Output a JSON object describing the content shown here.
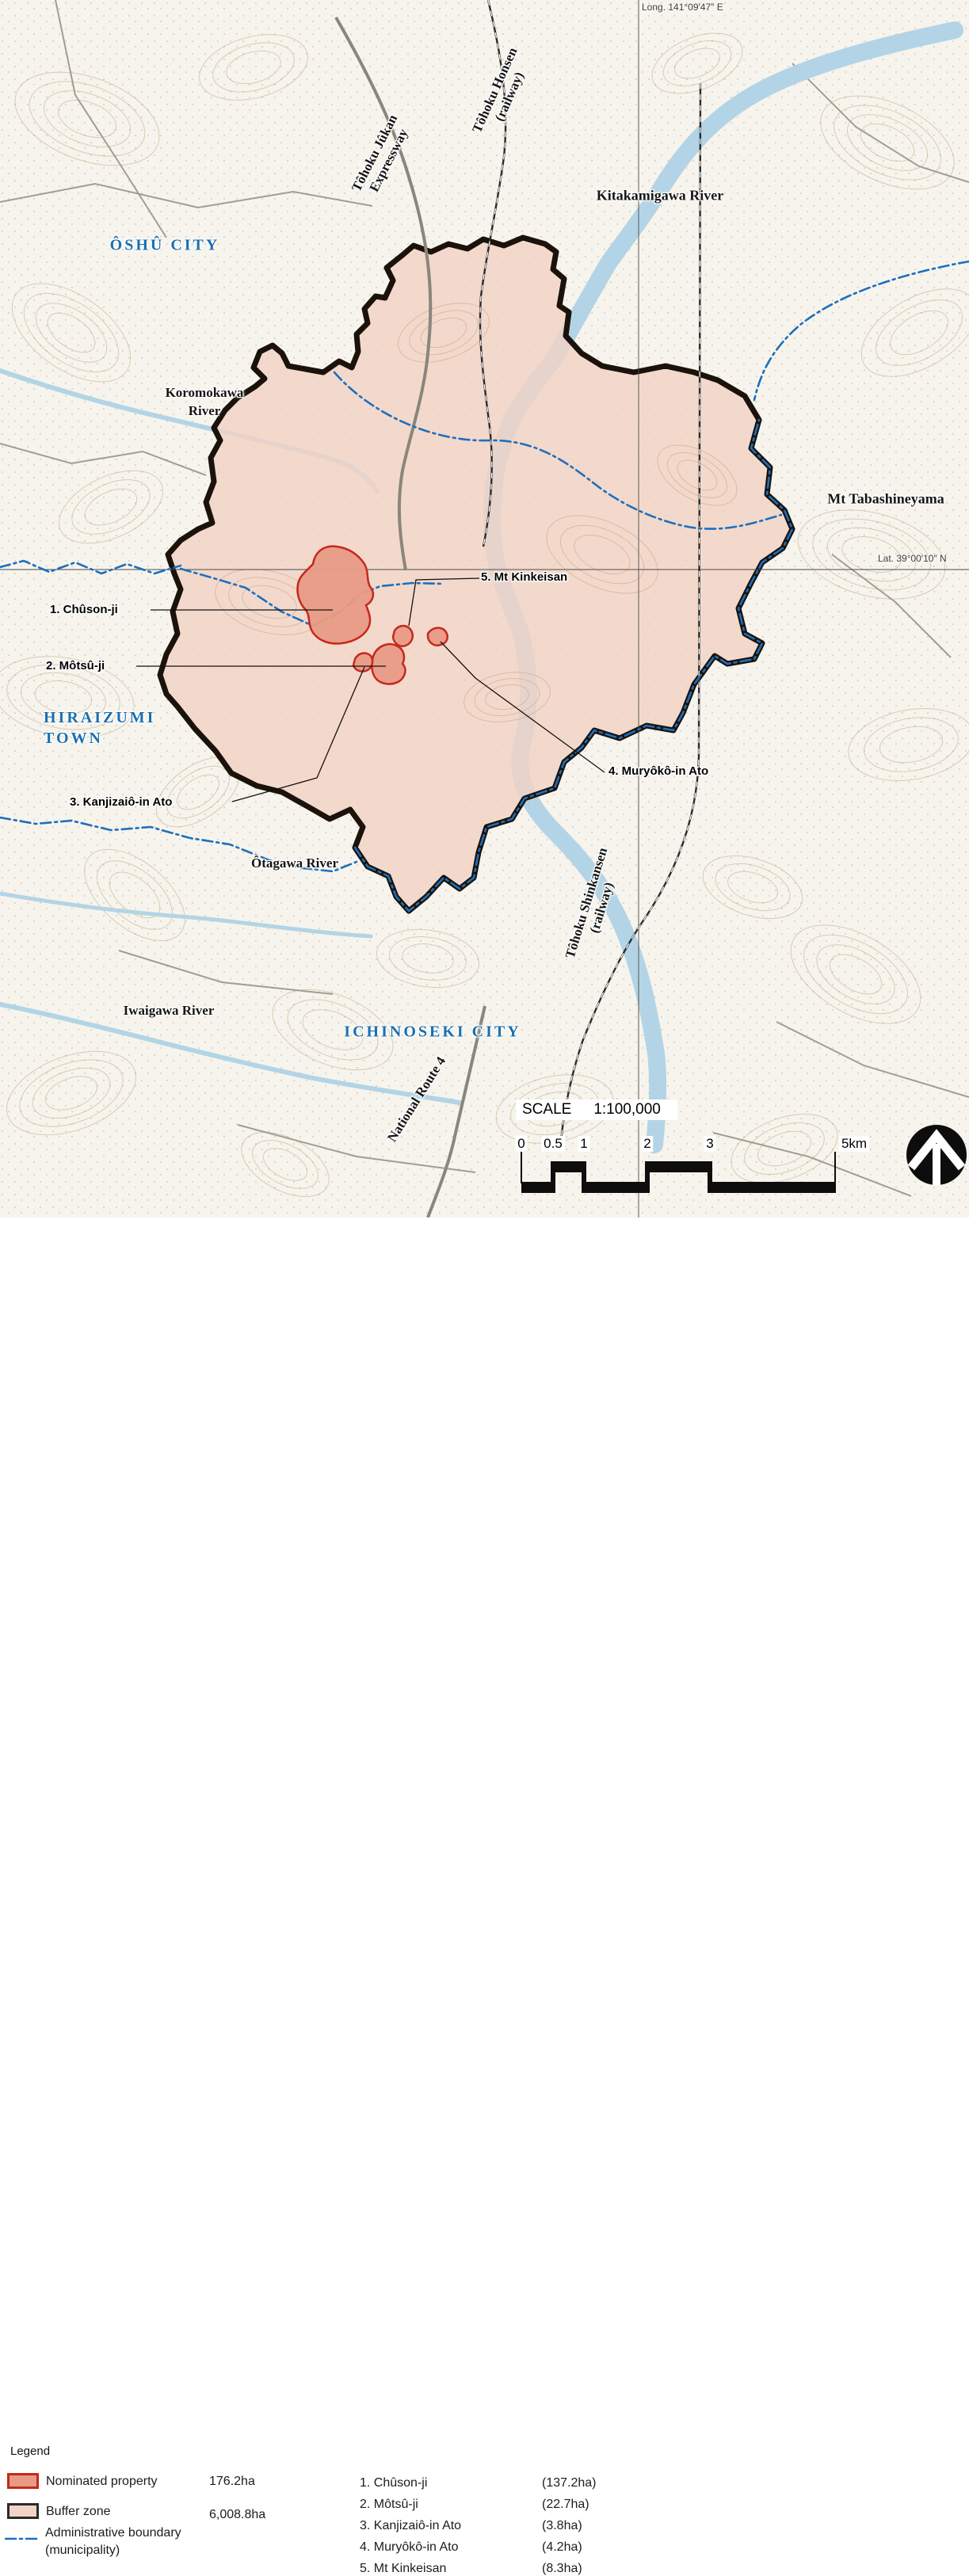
{
  "map": {
    "grid": {
      "long_label": "Long. 141°09′47″ E",
      "lat_label": "Lat. 39°00′10″ N"
    },
    "labels": {
      "oshu_city": "ÔSHÛ CITY",
      "hiraizumi_1": "HIRAIZUMI",
      "hiraizumi_2": "TOWN",
      "ichinoseki_city": "ICHINOSEKI CITY",
      "koromokawa_1": "Koromokawa",
      "koromokawa_2": "River",
      "kitakamigawa": "Kitakamigawa River",
      "otagawa": "Ôtagawa River",
      "iwaigawa": "Iwaigawa River",
      "tabashineyama": "Mt Tabashineyama",
      "jukan_1": "Tôhoku Jûkan",
      "jukan_2": "Expressway",
      "honsen_1": "Tôhoku Honsen",
      "honsen_2": "(railway)",
      "shinkansen_1": "Tôhoku Shinkansen",
      "shinkansen_2": "(railway)",
      "route4": "National Route 4"
    },
    "sites": {
      "s1": "1. Chûson-ji",
      "s2": "2. Môtsû-ji",
      "s3": "3. Kanjizaiô-in Ato",
      "s4": "4. Muryôkô-in Ato",
      "s5": "5. Mt Kinkeisan"
    },
    "scale": {
      "title": "SCALE",
      "ratio": "1:100,000",
      "ticks": [
        "0",
        "0.5",
        "1",
        "2",
        "3"
      ],
      "end_label": "5km"
    }
  },
  "legend": {
    "title": "Legend",
    "items": {
      "nominated": {
        "label": "Nominated property",
        "value": "176.2ha"
      },
      "buffer": {
        "label": "Buffer zone",
        "value": "6,008.8ha"
      },
      "admin": {
        "label": "Administrative boundary",
        "label2": "(municipality)"
      }
    },
    "sites": [
      {
        "name": "1. Chûson-ji",
        "area": "(137.2ha)"
      },
      {
        "name": "2. Môtsû-ji",
        "area": "(22.7ha)"
      },
      {
        "name": "3. Kanjizaiô-in Ato",
        "area": "(3.8ha)"
      },
      {
        "name": "4. Muryôkô-in Ato",
        "area": "(4.2ha)"
      },
      {
        "name": "5. Mt Kinkeisan",
        "area": "(8.3ha)"
      }
    ]
  },
  "colors": {
    "nominated_fill": "#e79b84",
    "nominated_border": "#c6281e",
    "buffer_fill": "#f2d3c5",
    "buffer_border": "#1a120b",
    "admin_blue": "#1d6fbd",
    "city_blue": "#1a6faf",
    "river": "#b3d4e6"
  }
}
